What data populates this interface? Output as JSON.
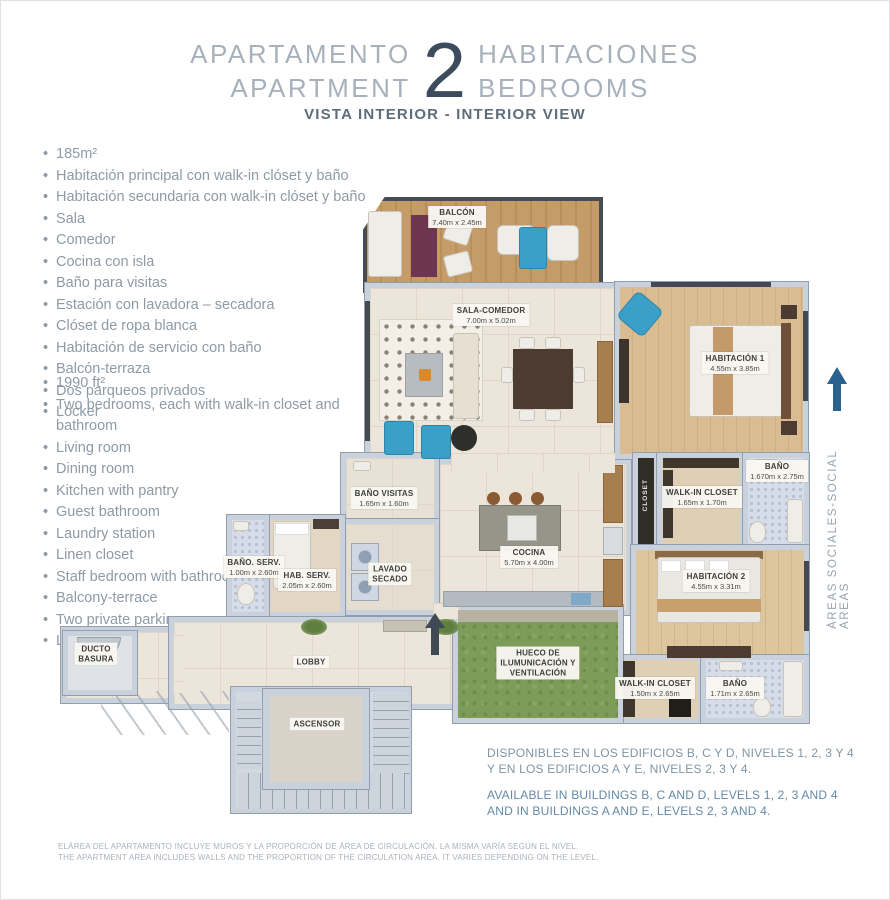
{
  "header": {
    "title_es_left": "APARTAMENTO",
    "title_en_left": "APARTMENT",
    "number": "2",
    "title_es_right": "HABITACIONES",
    "title_en_right": "BEDROOMS",
    "subtitle": "VISTA INTERIOR - INTERIOR VIEW"
  },
  "features_es": {
    "items": [
      "185m²",
      "Habitación principal con walk-in clóset y baño",
      "Habitación secundaria con walk-in clóset y baño",
      "Sala",
      "Comedor",
      "Cocina con isla",
      "Baño para visitas",
      "Estación con lavadora – secadora",
      "Clóset de ropa blanca",
      "Habitación de servicio con baño",
      "Balcón-terraza",
      "Dos parqueos privados",
      "Locker"
    ]
  },
  "features_en": {
    "items": [
      "1990 ft²",
      "Two bedrooms, each with walk-in closet and bathroom",
      "Living room",
      "Dining room",
      "Kitchen with pantry",
      "Guest bathroom",
      "Laundry station",
      "Linen closet",
      "Staff bedroom with bathroom",
      "Balcony-terrace",
      "Two private parking spaces",
      "Locker"
    ]
  },
  "plan": {
    "labels": {
      "balcon": {
        "name": "BALCÓN",
        "dims": "7.40m x 2.45m"
      },
      "sala": {
        "name": "SALA-COMEDOR",
        "dims": "7.00m x 5.02m"
      },
      "hab1": {
        "name": "HABITACIÓN 1",
        "dims": "4.55m x 3.85m"
      },
      "bano1": {
        "name": "BAÑO",
        "dims": "1.670m x 2.75m"
      },
      "walkin1": {
        "name": "WALK-IN CLOSET",
        "dims": "1.65m x 1.70m"
      },
      "closet": {
        "name": "CLOSET"
      },
      "hab2": {
        "name": "HABITACIÓN 2",
        "dims": "4.55m x 3.31m"
      },
      "walkin2": {
        "name": "WALK-IN CLOSET",
        "dims": "1.50m x 2.65m"
      },
      "bano2": {
        "name": "BAÑO",
        "dims": "1.71m x 2.65m"
      },
      "cocina": {
        "name": "COCINA",
        "dims": "5.70m x 4.00m"
      },
      "bano_visitas": {
        "name": "BAÑO VISITAS",
        "dims": "1.65m x 1.60m"
      },
      "lavado": {
        "line1": "LAVADO",
        "line2": "SECADO"
      },
      "bano_serv": {
        "name": "BAÑO. SERV.",
        "dims": "1.00m x 2.60m"
      },
      "hab_serv": {
        "name": "HAB. SERV.",
        "dims": "2.05m x 2.60m"
      },
      "ducto": {
        "line1": "DUCTO",
        "line2": "BASURA"
      },
      "lobby": {
        "name": "LOBBY"
      },
      "ascensor": {
        "name": "ASCENSOR"
      },
      "hueco": {
        "line1": "HUECO DE",
        "line2": "ILUMUNICACIÓN Y",
        "line3": "VENTILACIÓN"
      }
    },
    "side_note": "ÁREAS SOCIALES-SOCIAL AREAS"
  },
  "availability": {
    "es_line1": "DISPONIBLES EN LOS EDIFICIOS B, C Y D, NIVELES 1, 2, 3 Y 4",
    "es_line2": "Y EN LOS EDIFICIOS A Y E, NIVELES 2, 3 Y 4.",
    "en_line1": "AVAILABLE IN BUILDINGS B, C AND D, LEVELS 1, 2, 3 AND 4",
    "en_line2": "AND IN BUILDINGS A AND E, LEVELS 2, 3 AND 4."
  },
  "disclaimer": {
    "es": "ELÁREA DEL APARTAMENTO INCLUYE MUROS Y LA PROPORCIÓN DE ÁREA DE CIRCULACIÓN. LA MISMA VARÍA SEGÚN EL NIVEL.",
    "en": "THE APARTMENT AREA INCLUDES WALLS AND THE PROPORTION OF THE CIRCULATION AREA. IT VARIES DEPENDING ON THE LEVEL."
  },
  "colors": {
    "accent_navy": "#3c4c5c",
    "arrow_blue": "#2a618f",
    "heading_gray": "#a7b1bb",
    "text_gray": "#8e9aa6",
    "availability_blue": "#6389a9",
    "wall_gray": "#c9d2dc",
    "wood_tan": "#c59c67",
    "grass_green": "#7e9c59",
    "furniture_blue": "#3ba0c8"
  }
}
